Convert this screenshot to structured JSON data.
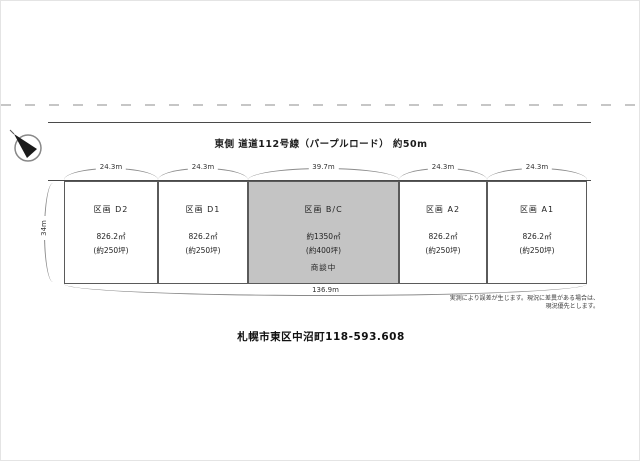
{
  "road": {
    "label": "東側 道道112号線（パープルロード） 約50m"
  },
  "compass": {
    "icon": "north-arrow"
  },
  "dimensions": {
    "top": [
      "24.3m",
      "24.3m",
      "39.7m",
      "24.3m",
      "24.3m"
    ],
    "left": "34m",
    "bottom": "136.9m"
  },
  "plots": [
    {
      "name": "区画 D2",
      "area": "826.2㎡",
      "tsubo": "(約250坪)",
      "status": ""
    },
    {
      "name": "区画 D1",
      "area": "826.2㎡",
      "tsubo": "(約250坪)",
      "status": ""
    },
    {
      "name": "区画 B/C",
      "area": "約1350㎡",
      "tsubo": "(約400坪)",
      "status": "商談中"
    },
    {
      "name": "区画 A2",
      "area": "826.2㎡",
      "tsubo": "(約250坪)",
      "status": ""
    },
    {
      "name": "区画 A1",
      "area": "826.2㎡",
      "tsubo": "(約250坪)",
      "status": ""
    }
  ],
  "disclaimer": "実測により誤差が生じます。現況に差異がある場合は、現況優先とします。",
  "address": "札幌市東区中沼町118-593.608",
  "colors": {
    "line": "#4a4a4a",
    "highlight_fill": "#c4c4c4",
    "dashed_line": "#c6c6c6"
  }
}
